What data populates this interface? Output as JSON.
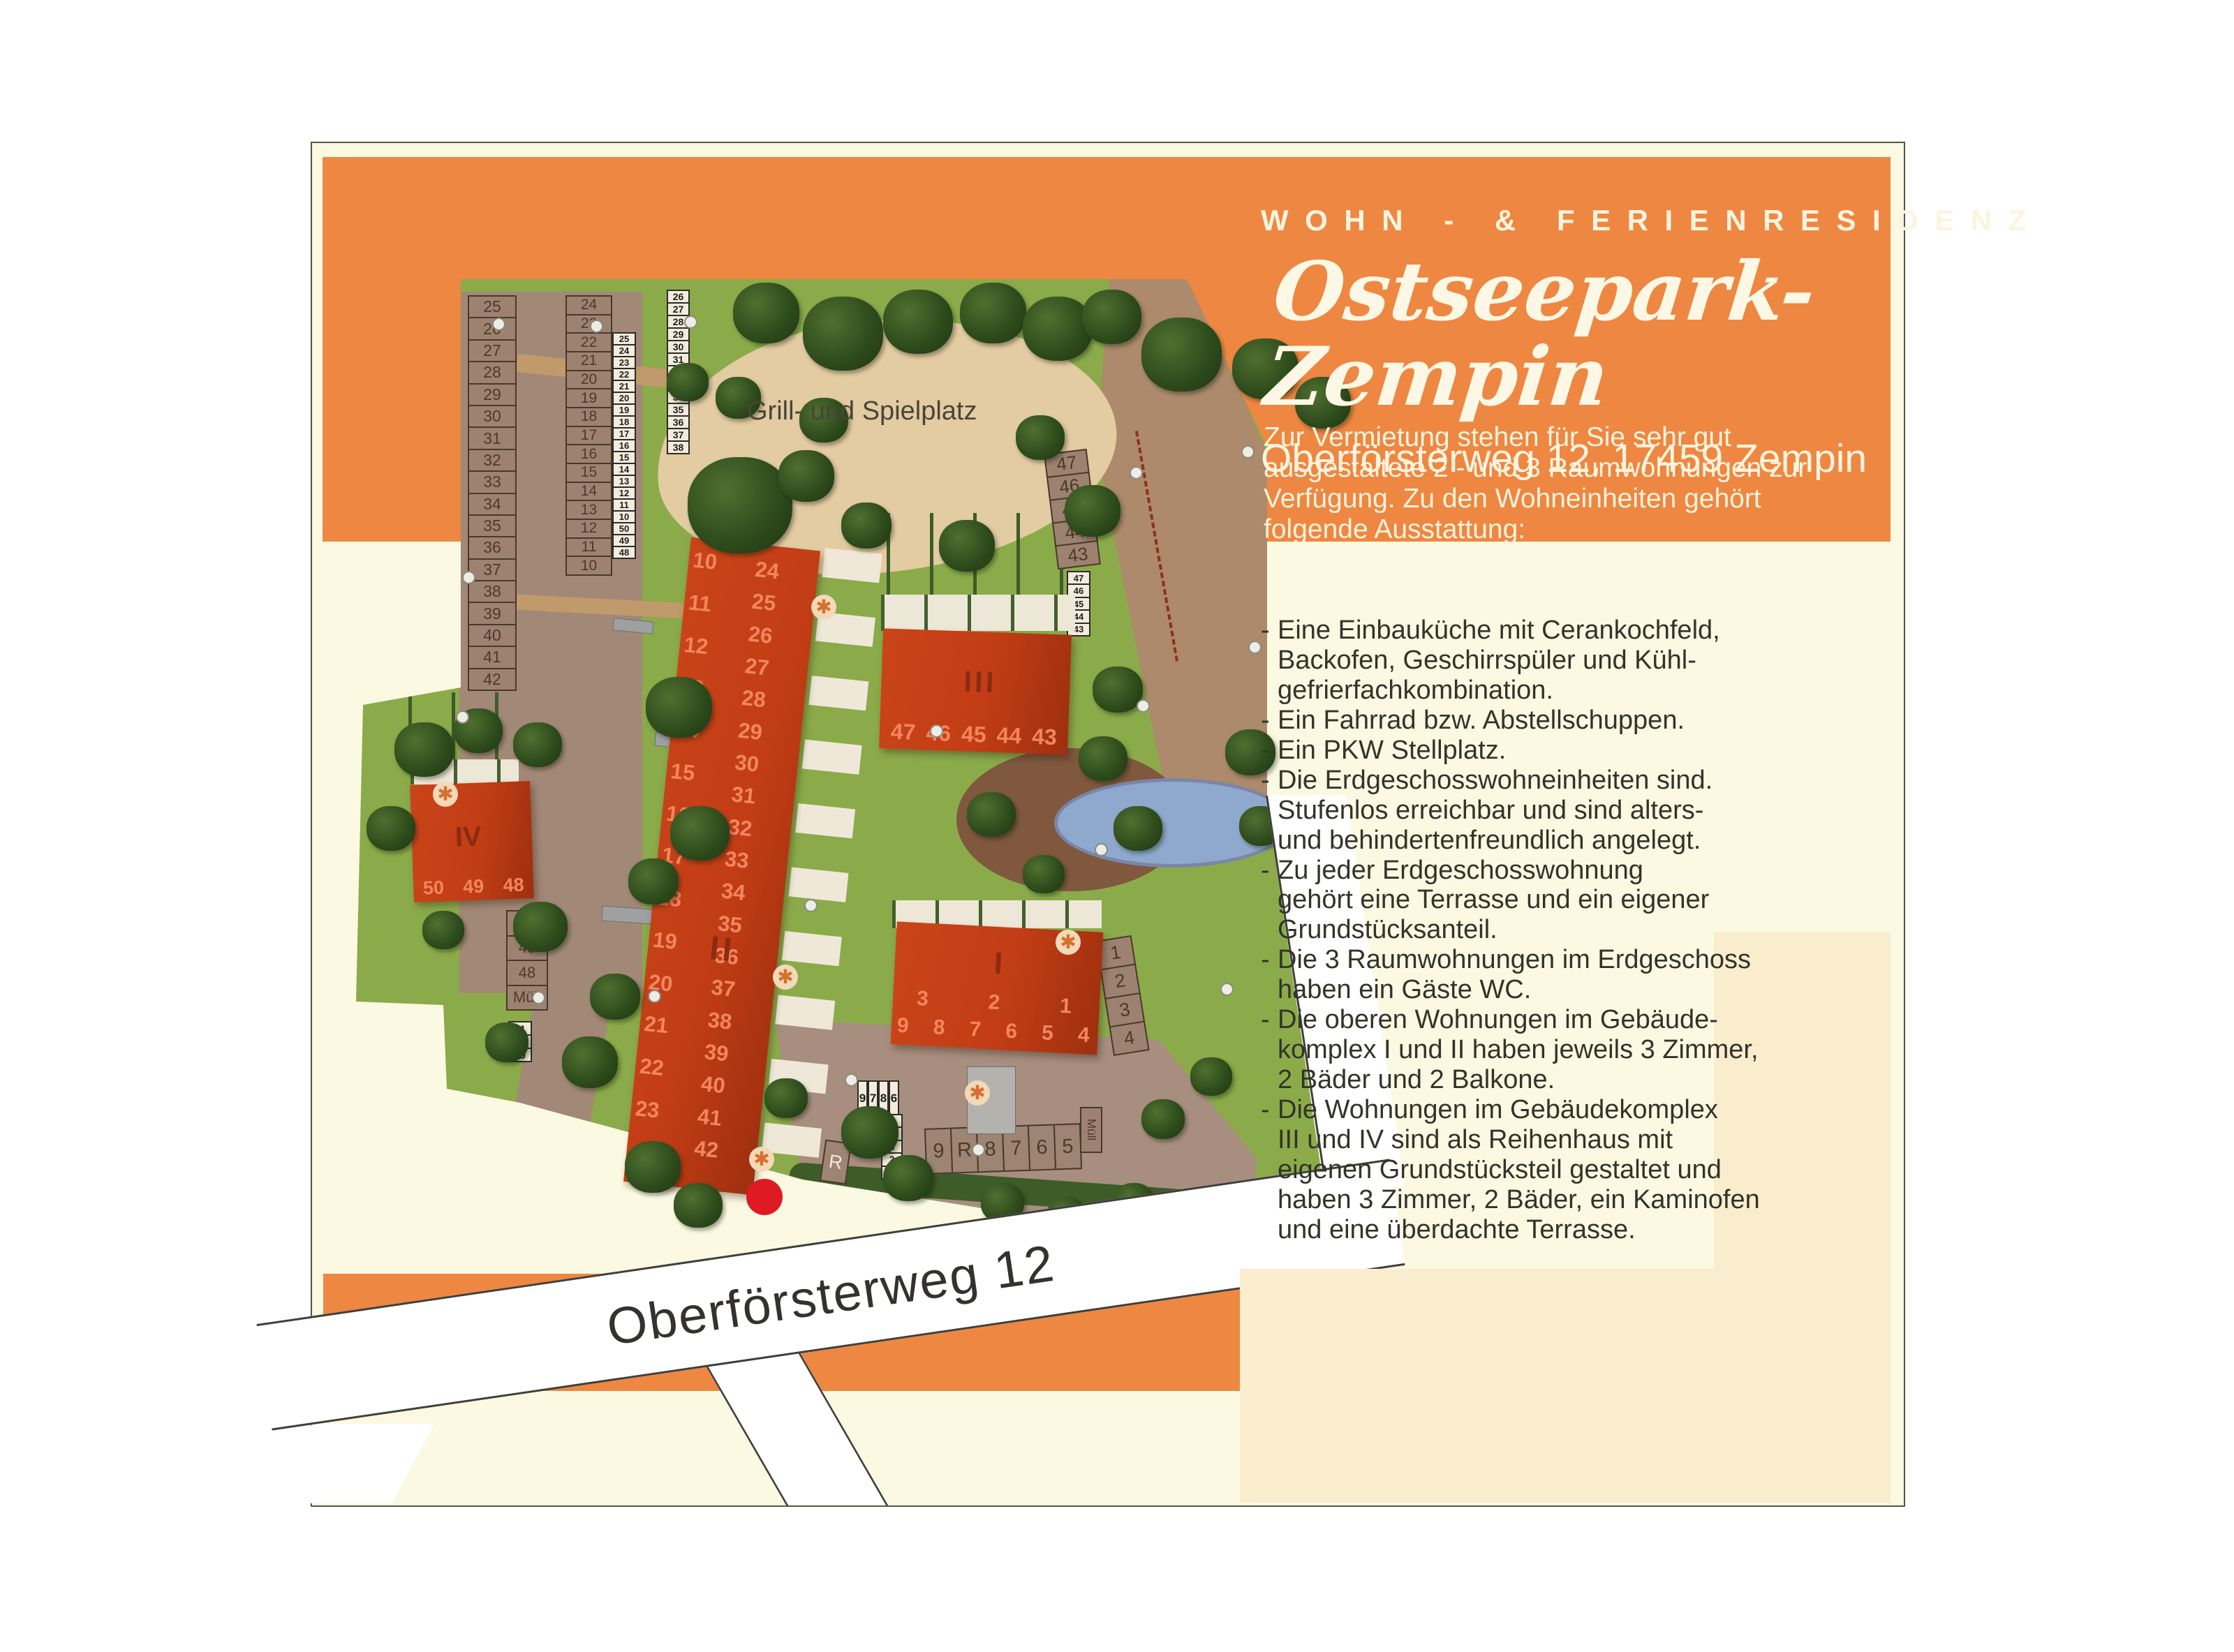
{
  "header": {
    "kicker": "WOHN - & FERIENRESIDENZ",
    "title": "Ostseepark-Zempin",
    "address": "Oberförsterweg 12, 17459 Zempin"
  },
  "intro": "Zur Vermietung stehen für Sie sehr gut\nausgestaltete 2 - und 3 Raumwohnungen zur\nVerfügung. Zu den Wohneinheiten gehört\nfolgende Ausstattung:",
  "features": [
    "Eine Einbauküche mit Cerankochfeld,\nBackofen, Geschirrspüler und Kühl-\ngefrierfachkombination.",
    "Ein Fahrrad bzw. Abstellschuppen.",
    "Ein PKW Stellplatz.",
    "Die Erdgeschosswohneinheiten sind.\nStufenlos erreichbar und sind alters-\nund behindertenfreundlich angelegt.",
    "Zu jeder Erdgeschosswohnung\ngehört eine Terrasse und ein eigener\nGrundstücksanteil.",
    "Die 3 Raumwohnungen im Erdgeschoss\nhaben ein Gäste WC.",
    "Die oberen Wohnungen im Gebäude-\nkomplex I und II haben jeweils 3 Zimmer,\n2 Bäder und 2 Balkone.",
    "Die Wohnungen im Gebäudekomplex\nIII und IV sind als Reihenhaus mit\neigenen Grundstücksteil gestaltet und\nhaben 3 Zimmer, 2 Bäder, ein Kaminofen\nund eine überdachte Terrasse."
  ],
  "map": {
    "playground_label": "Grill- und Spielplatz",
    "street_label": "Oberförsterweg 12",
    "muell": "Müll",
    "buildings": {
      "I": {
        "label": "I",
        "row_top": [
          "3",
          "2",
          "1"
        ],
        "row_bottom": [
          "9",
          "8",
          "7",
          "6",
          "5",
          "4"
        ]
      },
      "II": {
        "label": "II",
        "left_numbers": [
          "10",
          "11",
          "12",
          "13",
          "14",
          "15",
          "16",
          "17",
          "18",
          "19",
          "20",
          "21",
          "22",
          "23"
        ],
        "right_numbers": [
          "24",
          "25",
          "26",
          "27",
          "28",
          "29",
          "30",
          "31",
          "32",
          "33",
          "34",
          "35",
          "36",
          "37",
          "38",
          "39",
          "40",
          "41",
          "42"
        ]
      },
      "III": {
        "label": "III",
        "numbers": [
          "47",
          "46",
          "45",
          "44",
          "43"
        ]
      },
      "IV": {
        "label": "IV",
        "numbers": [
          "50",
          "49",
          "48"
        ]
      }
    },
    "parking": {
      "left_column": [
        "25",
        "26",
        "27",
        "28",
        "29",
        "30",
        "31",
        "32",
        "33",
        "34",
        "35",
        "36",
        "37",
        "38",
        "39",
        "40",
        "41",
        "42"
      ],
      "middle_column": [
        "24",
        "23",
        "22",
        "21",
        "20",
        "19",
        "18",
        "17",
        "16",
        "15",
        "14",
        "13",
        "12",
        "11",
        "10"
      ],
      "strip_inner": [
        "25",
        "24",
        "23",
        "22",
        "21",
        "20",
        "19",
        "18",
        "17",
        "16",
        "15",
        "14",
        "13",
        "12",
        "11",
        "10",
        "50",
        "49",
        "48"
      ],
      "strip_playground": [
        "26",
        "27",
        "28",
        "29",
        "30",
        "31",
        "32",
        "33",
        "34",
        "35",
        "36",
        "37",
        "38"
      ],
      "right_large": [
        "47",
        "46",
        "45",
        "44",
        "43"
      ],
      "strip_right": [
        "47",
        "46",
        "45",
        "44",
        "43"
      ],
      "east_column": [
        "1",
        "2",
        "3",
        "4"
      ],
      "south_row": [
        "9",
        "R",
        "8",
        "7",
        "6",
        "5"
      ],
      "sw_column": [
        "50",
        "49",
        "48",
        "Müll"
      ],
      "sw_strip": [
        "41",
        "40",
        "39"
      ],
      "center_pairs": [
        "9",
        "7",
        "8",
        "6"
      ],
      "center_single": [
        "5",
        "4",
        "3",
        "2",
        "1"
      ],
      "r_stall": "R"
    }
  }
}
